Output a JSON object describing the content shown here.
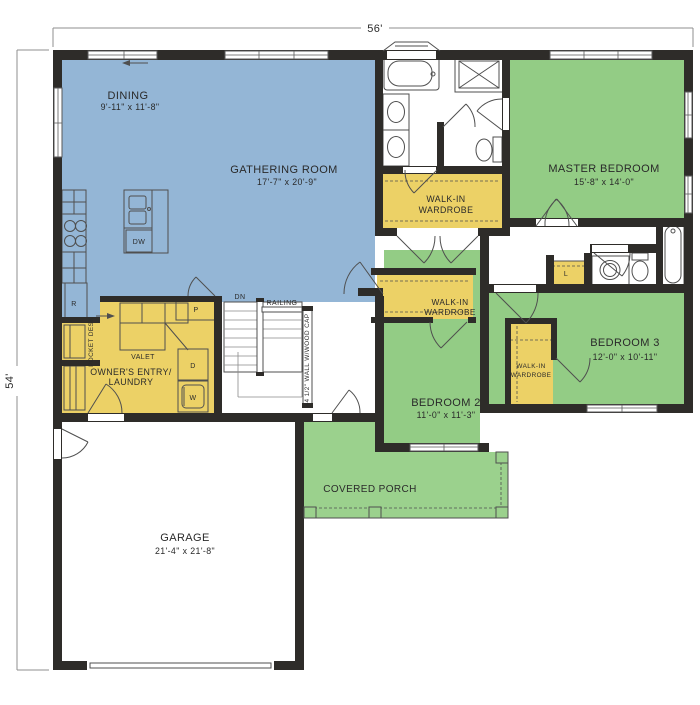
{
  "colors": {
    "room_blue": "#94b6d6",
    "room_green": "#93cc85",
    "porch_green": "#9bd18d",
    "room_yellow": "#ecd166",
    "wall": "#2e2c29",
    "fixture": "#4f4f4f",
    "text": "#2a2a2a",
    "dim": "#8f8f8f"
  },
  "dimensions": {
    "width_label": "56'",
    "height_label": "54'"
  },
  "rooms": {
    "dining": {
      "name": "DINING",
      "size": "9'-11\" x 11'-8\""
    },
    "gathering": {
      "name": "GATHERING ROOM",
      "size": "17'-7\" x 20'-9\""
    },
    "master_bedroom": {
      "name": "MASTER BEDROOM",
      "size": "15'-8\" x 14'-0\""
    },
    "master_wardrobe": {
      "line1": "WALK-IN",
      "line2": "WARDROBE"
    },
    "bedroom2": {
      "name": "BEDROOM 2",
      "size": "11'-0\" x 11'-3\""
    },
    "bedroom2_wardrobe": {
      "line1": "WALK-IN",
      "line2": "WARDROBE"
    },
    "bedroom3": {
      "name": "BEDROOM 3",
      "size": "12'-0\" x 10'-11\""
    },
    "bedroom3_wardrobe": {
      "line1": "WALK-IN",
      "line2": "WARDROBE"
    },
    "owners_entry": {
      "line1": "OWNER'S ENTRY/",
      "line2": "LAUNDRY"
    },
    "garage": {
      "name": "GARAGE",
      "size": "21'-4\" x 21'-8\""
    },
    "covered_porch": {
      "name": "COVERED PORCH"
    }
  },
  "annotations": {
    "stairs_dn": "DN",
    "railing": "RAILING",
    "half_wall": "44 1/2\" WALL W/WOOD CAP",
    "valet": "VALET",
    "pocket_desk": "POCKET DESK"
  },
  "appliances": {
    "dishwasher": "DW",
    "refrigerator": "R",
    "pantry": "P",
    "dryer": "D",
    "washer": "W",
    "linen": "L"
  }
}
